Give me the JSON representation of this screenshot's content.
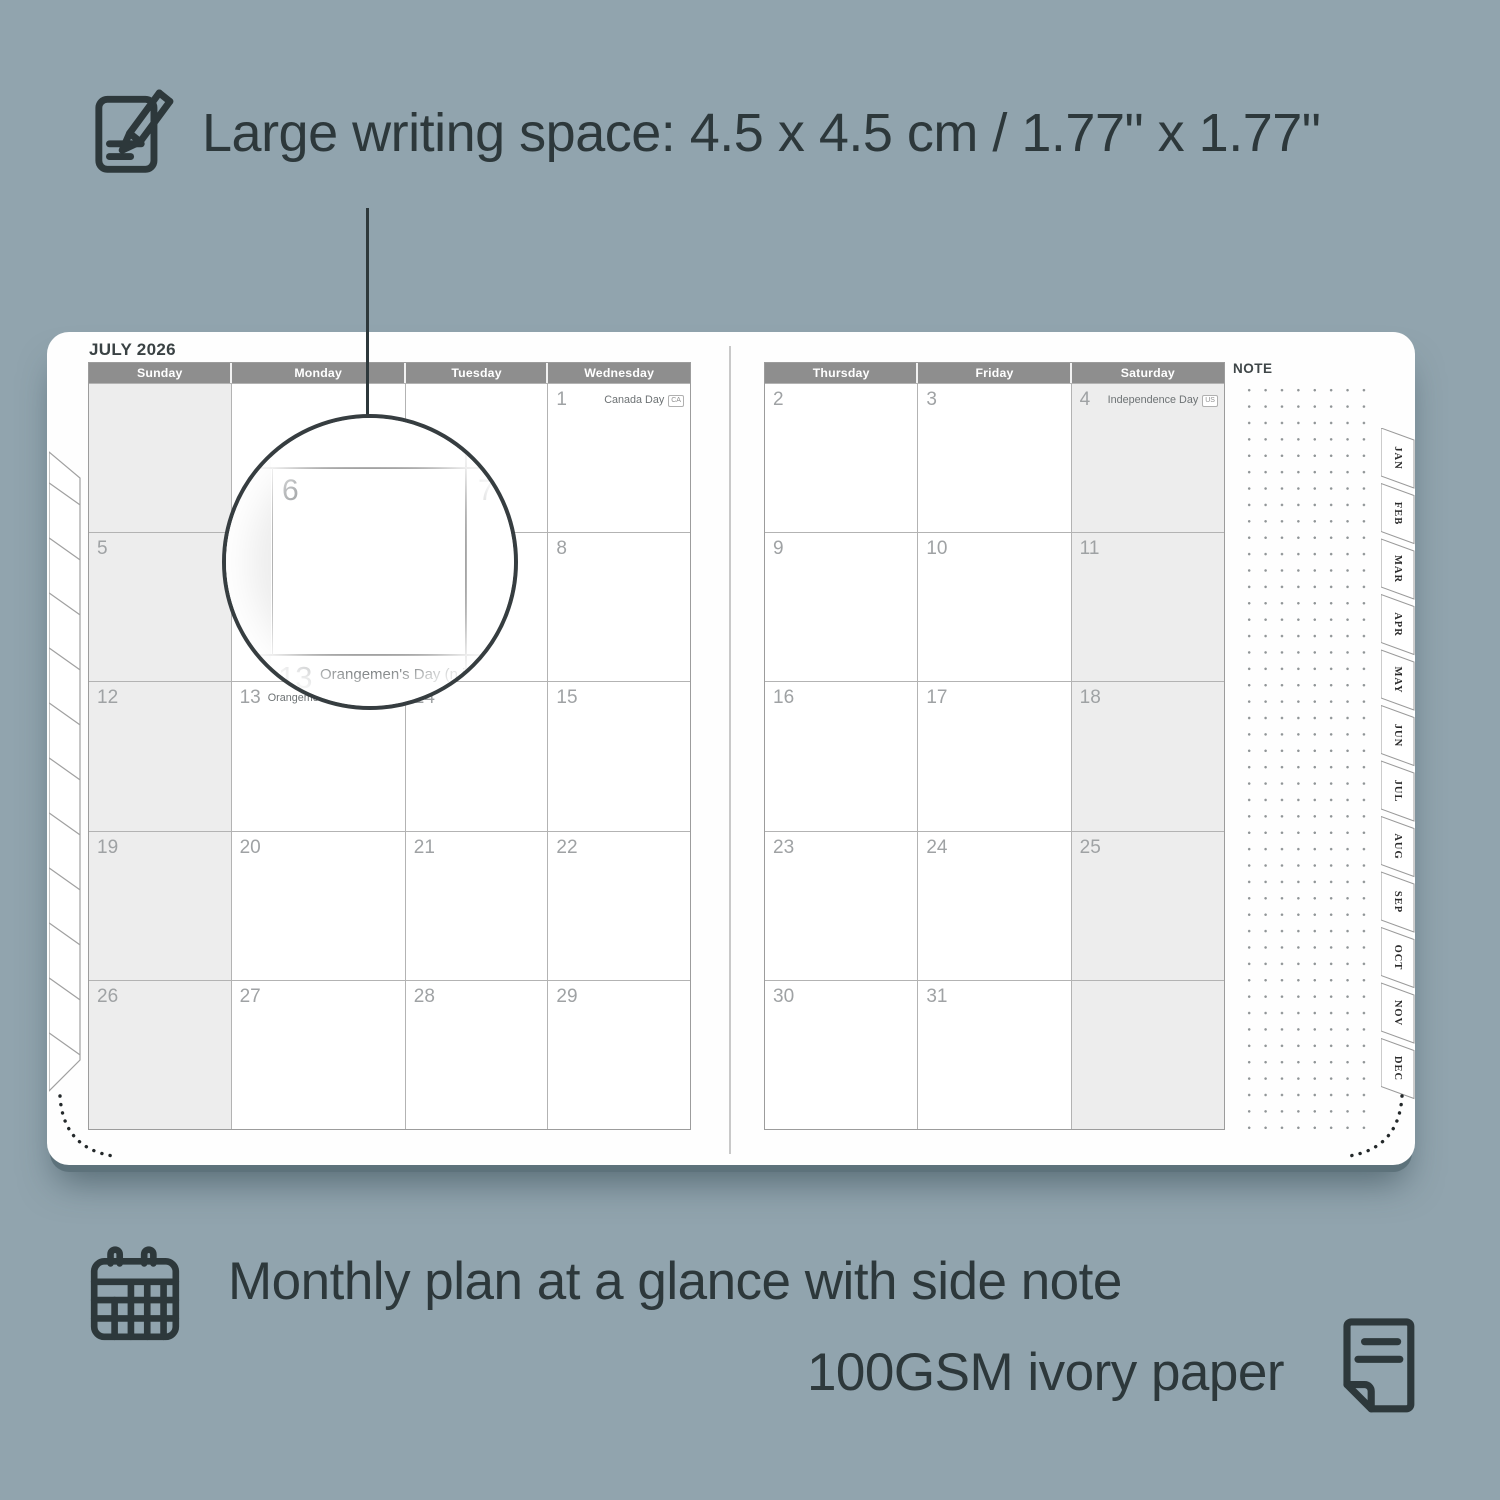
{
  "colors": {
    "background": "#91a4ae",
    "ink": "#2d383b",
    "header_bar": "#8e8e8e",
    "weekend_fill": "#ededed",
    "page": "#fefefe"
  },
  "feature_top": {
    "text": "Large writing space: 4.5 x 4.5 cm / 1.77\" x 1.77\""
  },
  "feature_monthly": {
    "text": "Monthly plan at a glance with side note"
  },
  "feature_paper": {
    "text": "100GSM ivory paper"
  },
  "planner": {
    "month_title": "JULY 2026",
    "note_label": "NOTE",
    "left_headers": [
      "Sunday",
      "Monday",
      "Tuesday",
      "Wednesday"
    ],
    "right_headers": [
      "Thursday",
      "Friday",
      "Saturday"
    ],
    "left_cells": [
      {
        "day": "",
        "weekend": true
      },
      {
        "day": ""
      },
      {
        "day": ""
      },
      {
        "day": "1",
        "holiday": "Canada Day",
        "badge": "CA"
      },
      {
        "day": "5",
        "weekend": true
      },
      {
        "day": "6"
      },
      {
        "day": "7"
      },
      {
        "day": "8"
      },
      {
        "day": "12",
        "weekend": true
      },
      {
        "day": "13",
        "holiday": "Orangemen's Day (n.i.)",
        "badge": "UK"
      },
      {
        "day": "14"
      },
      {
        "day": "15"
      },
      {
        "day": "19",
        "weekend": true
      },
      {
        "day": "20"
      },
      {
        "day": "21"
      },
      {
        "day": "22"
      },
      {
        "day": "26",
        "weekend": true
      },
      {
        "day": "27"
      },
      {
        "day": "28"
      },
      {
        "day": "29"
      }
    ],
    "right_cells": [
      {
        "day": "2"
      },
      {
        "day": "3"
      },
      {
        "day": "4",
        "holiday": "Independence Day",
        "badge": "US",
        "weekend": true
      },
      {
        "day": "9"
      },
      {
        "day": "10"
      },
      {
        "day": "11",
        "weekend": true
      },
      {
        "day": "16"
      },
      {
        "day": "17"
      },
      {
        "day": "18",
        "weekend": true
      },
      {
        "day": "23"
      },
      {
        "day": "24"
      },
      {
        "day": "25",
        "weekend": true
      },
      {
        "day": "30"
      },
      {
        "day": "31"
      },
      {
        "day": "",
        "weekend": true
      }
    ],
    "tabs": [
      "JAN",
      "FEB",
      "MAR",
      "APR",
      "MAY",
      "JUN",
      "JUL",
      "AUG",
      "SEP",
      "OCT",
      "NOV",
      "DEC"
    ]
  },
  "magnifier": {
    "day_left": "6",
    "day_right": "7",
    "partial_day": "13",
    "holiday": "Orangemen's Day (n.i.)",
    "badge": "UK"
  }
}
